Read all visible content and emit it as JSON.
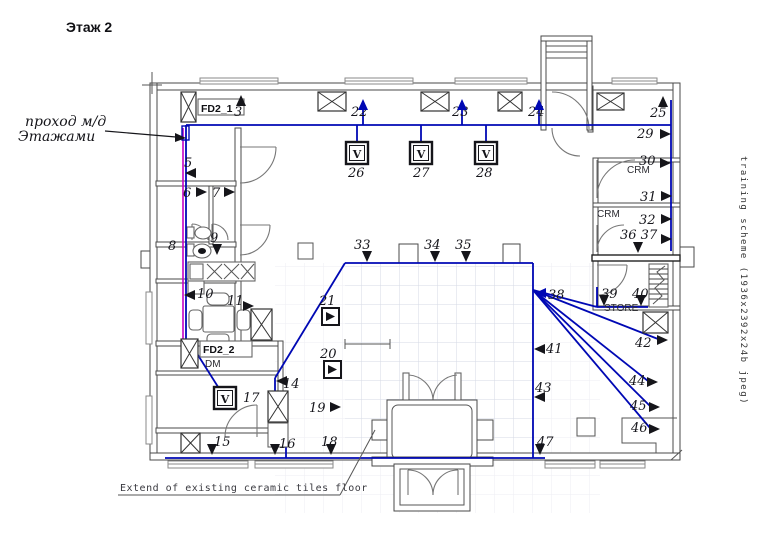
{
  "page": {
    "title": "Этаж 2",
    "handwritten_note_line1": "проход м/д",
    "handwritten_note_line2": "Этажами",
    "floor_note": "Extend of existing ceramic tiles floor",
    "side_text": "training scheme (1936x2392x24b jpeg)"
  },
  "labels": {
    "fd2_1": "FD2_1",
    "fd2_2": "FD2_2",
    "dm": "DM",
    "crm_upper": "CRM",
    "crm_lower": "CRM",
    "store": "STORE",
    "device_letter": "V"
  },
  "colors": {
    "blue": "#0008b4",
    "magenta": "#c400c4",
    "ink": "#15151a",
    "wall": "#4a4a4a",
    "grid": "#d6dae4"
  },
  "plan": {
    "cables_blue": [
      [
        186,
        125,
        671,
        125
      ],
      [
        671,
        100,
        671,
        251
      ],
      [
        357,
        125,
        357,
        144
      ],
      [
        421,
        125,
        421,
        144
      ],
      [
        486,
        125,
        486,
        144
      ],
      [
        363,
        125,
        363,
        101
      ],
      [
        462,
        125,
        462,
        101
      ],
      [
        539,
        125,
        539,
        101
      ],
      [
        186,
        125,
        186,
        343
      ],
      [
        196,
        352,
        220,
        390
      ],
      [
        345,
        263,
        533,
        263
      ],
      [
        533,
        263,
        533,
        458
      ],
      [
        345,
        263,
        275,
        378
      ],
      [
        275,
        378,
        275,
        393
      ],
      [
        275,
        393,
        286,
        393
      ],
      [
        286,
        393,
        286,
        458
      ],
      [
        165,
        458,
        545,
        458
      ],
      [
        597,
        287,
        597,
        307
      ],
      [
        597,
        307,
        648,
        307
      ],
      [
        533,
        290,
        658,
        339
      ],
      [
        533,
        290,
        648,
        381
      ],
      [
        533,
        290,
        650,
        406
      ],
      [
        533,
        290,
        650,
        428
      ],
      [
        533,
        290,
        597,
        307
      ]
    ],
    "cables_magenta": [
      [
        183,
        128,
        183,
        343
      ]
    ],
    "device_boxes": [
      [
        346,
        142
      ],
      [
        410,
        142
      ],
      [
        475,
        142
      ],
      [
        214,
        387
      ]
    ],
    "triangle_boxes": [
      [
        322,
        308
      ],
      [
        324,
        361
      ]
    ],
    "x_boxes": [
      [
        318,
        92,
        28,
        19
      ],
      [
        421,
        92,
        28,
        19
      ],
      [
        498,
        92,
        24,
        19
      ],
      [
        597,
        93,
        27,
        17
      ],
      [
        251,
        309,
        21,
        31
      ],
      [
        268,
        391,
        20,
        31
      ],
      [
        643,
        312,
        25,
        21
      ],
      [
        181,
        433,
        19,
        20
      ],
      [
        181,
        92,
        15,
        30
      ],
      [
        181,
        339,
        17,
        29
      ]
    ],
    "plain_boxes": [
      [
        298,
        243,
        15,
        16
      ],
      [
        577,
        418,
        18,
        18
      ],
      [
        268,
        423,
        20,
        24
      ]
    ],
    "markers": [
      {
        "l": "3",
        "tx": 234,
        "ty": 116,
        "a": [
          [
            241,
            106,
            "up",
            "ink"
          ]
        ]
      },
      {
        "l": "5",
        "tx": 184,
        "ty": 167,
        "a": [
          [
            196,
            173,
            "left",
            "ink"
          ]
        ]
      },
      {
        "l": "6",
        "tx": 183,
        "ty": 197,
        "a": [
          [
            196,
            192,
            "right",
            "ink"
          ]
        ]
      },
      {
        "l": "7",
        "tx": 212,
        "ty": 197,
        "a": [
          [
            224,
            192,
            "right",
            "ink"
          ]
        ]
      },
      {
        "l": "8",
        "tx": 168,
        "ty": 250,
        "a": []
      },
      {
        "l": "9",
        "tx": 210,
        "ty": 242,
        "a": [
          [
            217,
            244,
            "down",
            "ink"
          ]
        ]
      },
      {
        "l": "10",
        "tx": 197,
        "ty": 298,
        "a": [
          [
            195,
            295,
            "left",
            "ink"
          ]
        ]
      },
      {
        "l": "11",
        "tx": 227,
        "ty": 305,
        "a": [
          [
            243,
            306,
            "right",
            "ink"
          ]
        ]
      },
      {
        "l": "14",
        "tx": 283,
        "ty": 388,
        "a": [
          [
            287,
            381,
            "left",
            "ink"
          ]
        ]
      },
      {
        "l": "15",
        "tx": 214,
        "ty": 446,
        "a": [
          [
            212,
            444,
            "down",
            "ink"
          ]
        ]
      },
      {
        "l": "16",
        "tx": 279,
        "ty": 448,
        "a": [
          [
            275,
            444,
            "down",
            "ink"
          ]
        ]
      },
      {
        "l": "17",
        "tx": 243,
        "ty": 402,
        "a": []
      },
      {
        "l": "18",
        "tx": 321,
        "ty": 446,
        "a": [
          [
            331,
            444,
            "down",
            "ink"
          ]
        ]
      },
      {
        "l": "19",
        "tx": 309,
        "ty": 412,
        "a": [
          [
            330,
            407,
            "right",
            "ink"
          ]
        ]
      },
      {
        "l": "20",
        "tx": 320,
        "ty": 358,
        "a": []
      },
      {
        "l": "21",
        "tx": 319,
        "ty": 305,
        "a": []
      },
      {
        "l": "22",
        "tx": 351,
        "ty": 116,
        "a": [
          [
            363,
            110,
            "up",
            "blue"
          ]
        ]
      },
      {
        "l": "23",
        "tx": 452,
        "ty": 116,
        "a": [
          [
            462,
            110,
            "up",
            "blue"
          ]
        ]
      },
      {
        "l": "24",
        "tx": 528,
        "ty": 116,
        "a": [
          [
            539,
            110,
            "up",
            "blue"
          ]
        ]
      },
      {
        "l": "25",
        "tx": 650,
        "ty": 117,
        "a": [
          [
            663,
            107,
            "up",
            "ink"
          ]
        ]
      },
      {
        "l": "26",
        "tx": 348,
        "ty": 177,
        "a": []
      },
      {
        "l": "27",
        "tx": 413,
        "ty": 177,
        "a": []
      },
      {
        "l": "28",
        "tx": 476,
        "ty": 177,
        "a": []
      },
      {
        "l": "29",
        "tx": 637,
        "ty": 138,
        "a": [
          [
            660,
            134,
            "right",
            "ink"
          ]
        ]
      },
      {
        "l": "30",
        "tx": 639,
        "ty": 165,
        "a": [
          [
            660,
            163,
            "right",
            "ink"
          ]
        ]
      },
      {
        "l": "31",
        "tx": 640,
        "ty": 201,
        "a": [
          [
            661,
            196,
            "right",
            "ink"
          ]
        ]
      },
      {
        "l": "32",
        "tx": 639,
        "ty": 224,
        "a": [
          [
            661,
            219,
            "right",
            "ink"
          ]
        ]
      },
      {
        "l": "33",
        "tx": 354,
        "ty": 249,
        "a": [
          [
            367,
            251,
            "down",
            "ink"
          ]
        ]
      },
      {
        "l": "34",
        "tx": 424,
        "ty": 249,
        "a": [
          [
            435,
            251,
            "down",
            "ink"
          ]
        ]
      },
      {
        "l": "35",
        "tx": 455,
        "ty": 249,
        "a": [
          [
            466,
            251,
            "down",
            "ink"
          ]
        ]
      },
      {
        "l": "36 37",
        "tx": 620,
        "ty": 239,
        "a": [
          [
            638,
            242,
            "down",
            "ink"
          ],
          [
            661,
            239,
            "right",
            "ink"
          ]
        ]
      },
      {
        "l": "38",
        "tx": 548,
        "ty": 299,
        "a": [
          [
            546,
            293,
            "left",
            "blue"
          ]
        ]
      },
      {
        "l": "39",
        "tx": 601,
        "ty": 298,
        "a": [
          [
            604,
            295,
            "down",
            "ink"
          ]
        ]
      },
      {
        "l": "40",
        "tx": 632,
        "ty": 298,
        "a": [
          [
            641,
            295,
            "down",
            "ink"
          ]
        ]
      },
      {
        "l": "41",
        "tx": 546,
        "ty": 353,
        "a": [
          [
            545,
            349,
            "left",
            "ink"
          ]
        ]
      },
      {
        "l": "42",
        "tx": 635,
        "ty": 347,
        "a": [
          [
            657,
            340,
            "right",
            "ink"
          ]
        ]
      },
      {
        "l": "43",
        "tx": 535,
        "ty": 392,
        "a": [
          [
            545,
            397,
            "left",
            "ink"
          ]
        ]
      },
      {
        "l": "44",
        "tx": 629,
        "ty": 385,
        "a": [
          [
            647,
            382,
            "right",
            "ink"
          ]
        ]
      },
      {
        "l": "45",
        "tx": 630,
        "ty": 410,
        "a": [
          [
            649,
            407,
            "right",
            "ink"
          ]
        ]
      },
      {
        "l": "46",
        "tx": 631,
        "ty": 432,
        "a": [
          [
            649,
            429,
            "right",
            "ink"
          ]
        ]
      },
      {
        "l": "47",
        "tx": 537,
        "ty": 446,
        "a": [
          [
            540,
            444,
            "down",
            "ink"
          ]
        ]
      }
    ]
  }
}
